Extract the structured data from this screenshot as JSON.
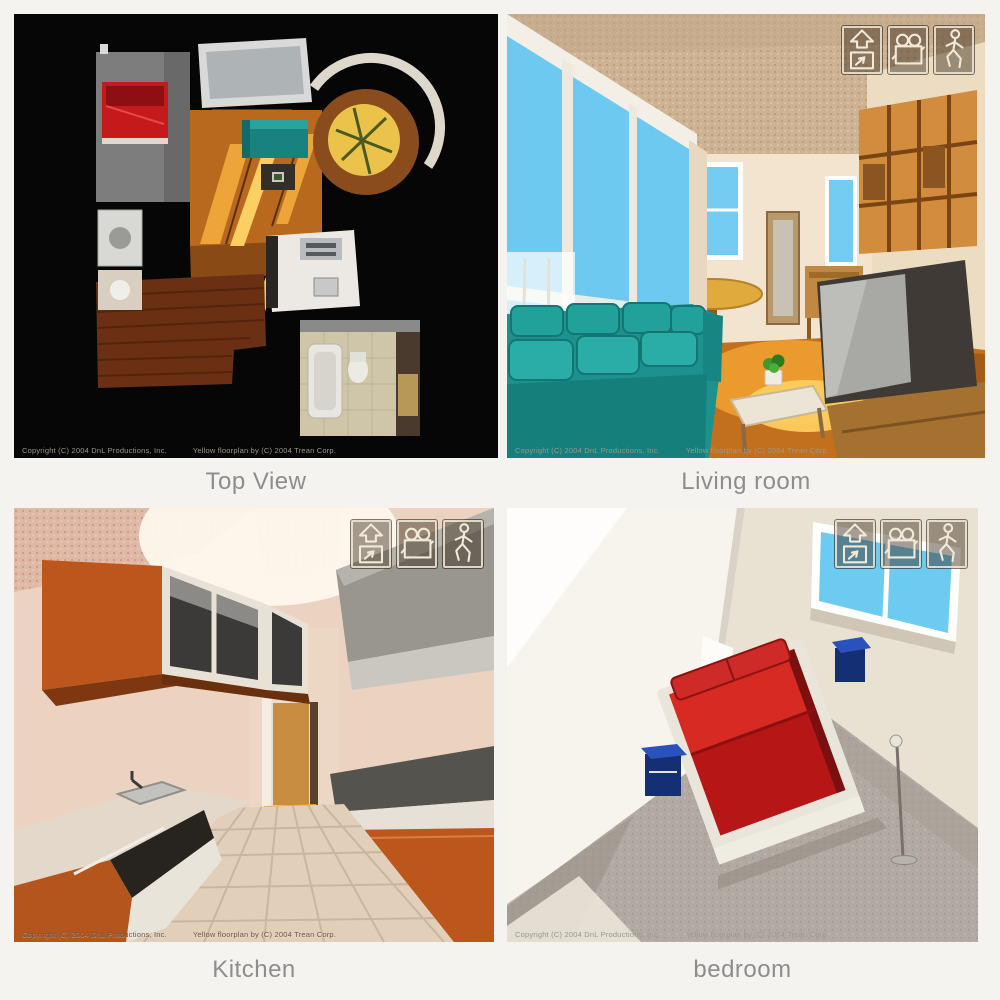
{
  "page": {
    "background": "#f5f3f0"
  },
  "colors": {
    "page-bg": "#f5f3f0",
    "caption": "#8d8d8d",
    "copy-light": "#9a968e",
    "copy-dark": "#6a564a",
    "icon-stroke": "#f2ead8",
    "icon-bg": "rgba(55,40,25,0.45)",
    "sky-blue": "#6ec9f0",
    "sofa-teal": "#1d918d",
    "bed-red": "#c01a1a",
    "cabinet-orange": "#bc561c"
  },
  "views": [
    {
      "id": "top-view",
      "caption": "Top View",
      "copyright_left": "Copyright (C) 2004 DnL Productions, Inc.",
      "copyright_right": "Yellow floorplan by (C) 2004 Trean Corp."
    },
    {
      "id": "living-room",
      "caption": "Living room",
      "copyright_left": "Copyright (C) 2004 DnL Productions, Inc.",
      "copyright_right": "Yellow floorplan by (C) 2004 Trean Corp."
    },
    {
      "id": "kitchen",
      "caption": "Kitchen",
      "copyright_left": "Copyright (C) 2004 DnL Productions, Inc.",
      "copyright_right": "Yellow floorplan by (C) 2004 Trean Corp."
    },
    {
      "id": "bedroom",
      "caption": "bedroom",
      "copyright_left": "Copyright (C) 2004 DnL Productions, Inc.",
      "copyright_right": "Yellow floorplan by (C) 2004 Trean Corp."
    }
  ],
  "toolbar": {
    "buttons": [
      {
        "icon": "floorplan-arrow-icon",
        "name": "floorplan-view-button"
      },
      {
        "icon": "movie-camera-icon",
        "name": "camera-view-button"
      },
      {
        "icon": "walking-person-icon",
        "name": "walkthrough-view-button"
      }
    ]
  }
}
